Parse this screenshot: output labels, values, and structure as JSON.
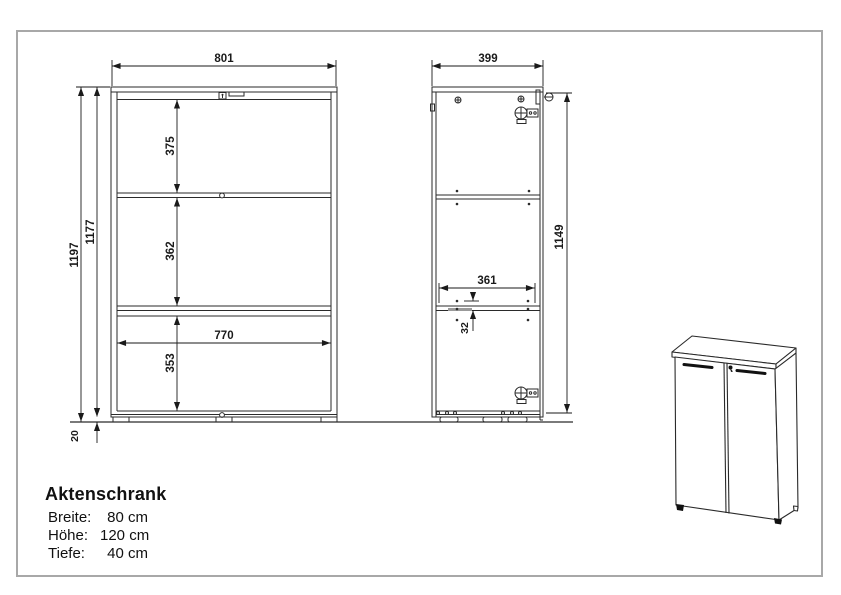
{
  "drawing": {
    "title": "Aktenschrank",
    "specs": [
      {
        "label": "Breite:",
        "value": "80 cm"
      },
      {
        "label": "Höhe:",
        "value": "120 cm"
      },
      {
        "label": "Tiefe:",
        "value": "40 cm"
      }
    ],
    "front_view": {
      "width_label": "801",
      "height_total_label": "1197",
      "height_body_label": "1177",
      "top_section_label": "375",
      "middle_section_label": "362",
      "bottom_section_label": "353",
      "inner_width_label": "770",
      "feet_height_label": "20"
    },
    "side_view": {
      "depth_label": "399",
      "height_label": "1149",
      "inner_depth_label": "361",
      "hole_spacing_label": "32"
    },
    "colors": {
      "line": "#2a2a2a",
      "border": "#a8a8a8",
      "background": "#ffffff",
      "hardware": "#111111"
    }
  }
}
